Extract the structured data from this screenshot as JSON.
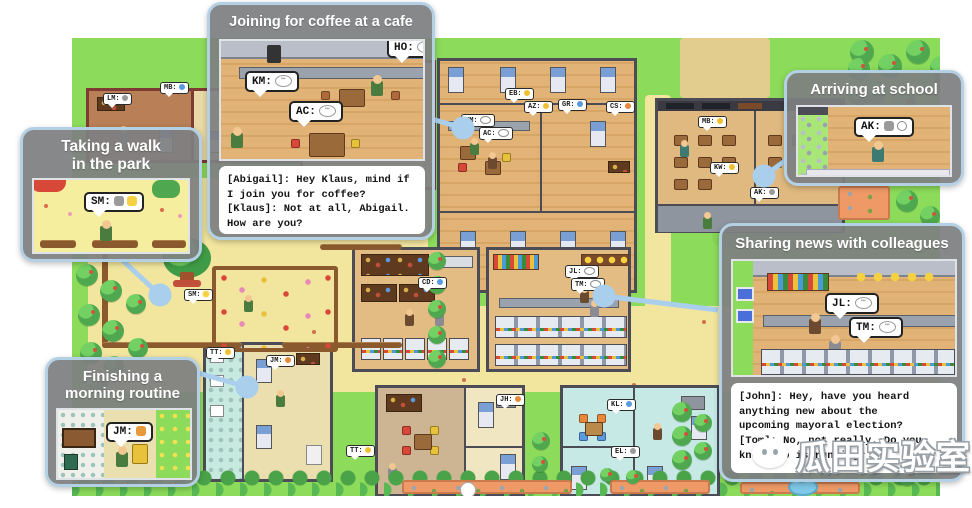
{
  "colors": {
    "grass": "#8cdb5a",
    "sand": "#f2e59e",
    "wood": "#e2b377",
    "callout_bg": "#7e7f81",
    "callout_border": "#b3d0e4",
    "connector": "#a9cfec",
    "tree": "#4fa84f"
  },
  "callouts": {
    "coffee": {
      "title": "Joining for coffee at a cafe",
      "bubbles": [
        {
          "label": "KM:"
        },
        {
          "label": "AC:"
        },
        {
          "label": "HO:"
        }
      ],
      "dialogue": "[Abigail]: Hey Klaus, mind if\nI join you for coffee?\n[Klaus]: Not at all, Abigail.\nHow are you?"
    },
    "walk": {
      "title": "Taking a walk\nin the park",
      "bubble": {
        "label": "SM:"
      }
    },
    "school": {
      "title": "Arriving at school",
      "bubble": {
        "label": "AK:"
      }
    },
    "news": {
      "title": "Sharing news with colleagues",
      "bubbles": [
        {
          "label": "JL:"
        },
        {
          "label": "TM:"
        }
      ],
      "dialogue": "[John]: Hey, have you heard\nanything new about the\nupcoming mayoral election?\n[Tom]: No, not really. Do you\nknow who is running?"
    },
    "routine": {
      "title": "Finishing a\nmorning routine",
      "bubble": {
        "label": "JM:"
      }
    }
  },
  "map": {
    "bubbles": [
      {
        "label": "LM:",
        "icon": "gray",
        "x": 103,
        "y": 93
      },
      {
        "label": "MB:",
        "icon": "blue",
        "x": 160,
        "y": 82
      },
      {
        "label": "EB:",
        "icon": "yellow",
        "x": 505,
        "y": 88
      },
      {
        "label": "AZ:",
        "icon": "yellow",
        "x": 524,
        "y": 101
      },
      {
        "label": "KM:",
        "icon": "chat",
        "x": 461,
        "y": 114
      },
      {
        "label": "AC:",
        "icon": "chat",
        "x": 479,
        "y": 127
      },
      {
        "label": "GR:",
        "icon": "blue",
        "x": 558,
        "y": 99
      },
      {
        "label": "CS:",
        "icon": "orange",
        "x": 606,
        "y": 101
      },
      {
        "label": "MB:",
        "icon": "yellow",
        "x": 698,
        "y": 116
      },
      {
        "label": "KW:",
        "icon": "yellow",
        "x": 710,
        "y": 162
      },
      {
        "label": "AK:",
        "icon": "gray",
        "x": 750,
        "y": 187
      },
      {
        "label": "CD:",
        "icon": "blue",
        "x": 418,
        "y": 277
      },
      {
        "label": "JL:",
        "icon": "chat",
        "x": 565,
        "y": 265
      },
      {
        "label": "TM:",
        "icon": "chat",
        "x": 571,
        "y": 278
      },
      {
        "label": "SM:",
        "icon": "spark",
        "x": 184,
        "y": 289
      },
      {
        "label": "TT:",
        "icon": "yellow",
        "x": 206,
        "y": 347
      },
      {
        "label": "JM:",
        "icon": "orange",
        "x": 266,
        "y": 355
      },
      {
        "label": "TT:",
        "icon": "yellow",
        "x": 346,
        "y": 445
      },
      {
        "label": "EL:",
        "icon": "gray",
        "x": 611,
        "y": 446
      },
      {
        "label": "KL:",
        "icon": "blue",
        "x": 607,
        "y": 399
      },
      {
        "label": "JH:",
        "icon": "orange",
        "x": 496,
        "y": 394
      }
    ],
    "trees": [
      [
        238,
        42,
        22
      ],
      [
        262,
        56,
        22
      ],
      [
        288,
        42,
        22
      ],
      [
        246,
        72,
        20
      ],
      [
        850,
        40,
        24
      ],
      [
        878,
        54,
        24
      ],
      [
        906,
        40,
        24
      ],
      [
        930,
        56,
        22
      ],
      [
        862,
        80,
        24
      ],
      [
        892,
        92,
        24
      ],
      [
        920,
        74,
        22
      ],
      [
        856,
        108,
        22
      ],
      [
        886,
        120,
        22
      ],
      [
        848,
        58,
        22
      ],
      [
        848,
        84,
        22
      ],
      [
        896,
        190,
        22
      ],
      [
        920,
        206,
        20
      ],
      [
        76,
        264,
        22
      ],
      [
        100,
        280,
        22
      ],
      [
        78,
        304,
        22
      ],
      [
        102,
        320,
        22
      ],
      [
        80,
        342,
        22
      ],
      [
        104,
        356,
        20
      ],
      [
        128,
        338,
        20
      ],
      [
        126,
        294,
        20
      ],
      [
        90,
        376,
        18
      ],
      [
        428,
        252,
        18
      ],
      [
        428,
        276,
        18
      ],
      [
        428,
        300,
        18
      ],
      [
        428,
        326,
        18
      ],
      [
        428,
        350,
        18
      ],
      [
        672,
        402,
        20
      ],
      [
        672,
        426,
        20
      ],
      [
        672,
        450,
        20
      ],
      [
        694,
        414,
        18
      ],
      [
        694,
        442,
        18
      ],
      [
        532,
        432,
        18
      ],
      [
        532,
        456,
        16
      ],
      [
        862,
        428,
        22
      ],
      [
        888,
        442,
        22
      ],
      [
        914,
        428,
        20
      ],
      [
        934,
        450,
        20
      ],
      [
        864,
        460,
        20
      ],
      [
        898,
        468,
        18
      ],
      [
        820,
        458,
        18
      ],
      [
        794,
        466,
        16
      ],
      [
        600,
        468,
        14
      ],
      [
        626,
        470,
        14
      ]
    ]
  },
  "watermark": {
    "text": "瓜田实验室",
    "icon": "wechat-icon"
  }
}
